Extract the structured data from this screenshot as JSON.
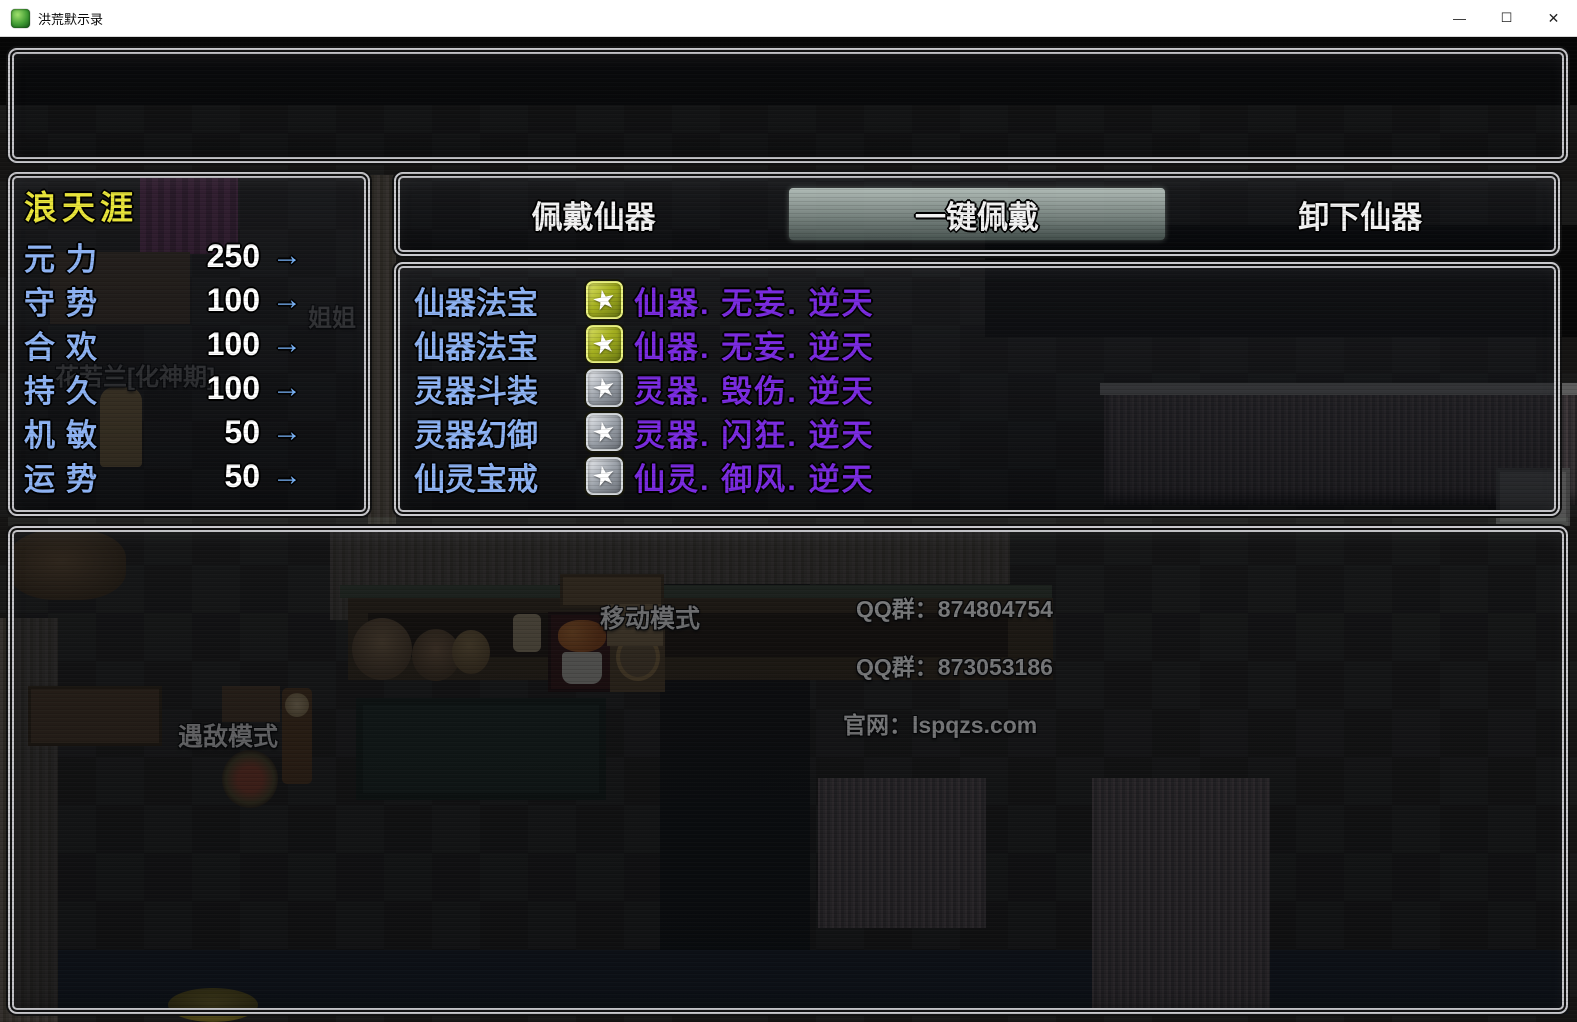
{
  "window": {
    "title": "洪荒默示录",
    "controls": {
      "minimize": "—",
      "maximize": "☐",
      "close": "✕"
    }
  },
  "stats_panel": {
    "character_name": "浪天涯",
    "stats": [
      {
        "label": "元力",
        "value": "250",
        "arrow": "→"
      },
      {
        "label": "守势",
        "value": "100",
        "arrow": "→"
      },
      {
        "label": "合欢",
        "value": "100",
        "arrow": "→"
      },
      {
        "label": "持久",
        "value": "100",
        "arrow": "→"
      },
      {
        "label": "机敏",
        "value": "50",
        "arrow": "→"
      },
      {
        "label": "运势",
        "value": "50",
        "arrow": "→"
      }
    ]
  },
  "tab_bar": {
    "tabs": [
      {
        "label": "佩戴仙器",
        "selected": false
      },
      {
        "label": "一键佩戴",
        "selected": true
      },
      {
        "label": "卸下仙器",
        "selected": false
      }
    ]
  },
  "equipment_panel": {
    "items": [
      {
        "slot": "仙器法宝",
        "star": "gold",
        "star_glyph": "★",
        "name": "仙器. 无妄. 逆天"
      },
      {
        "slot": "仙器法宝",
        "star": "gold",
        "star_glyph": "★",
        "name": "仙器. 无妄. 逆天"
      },
      {
        "slot": "灵器斗装",
        "star": "silver",
        "star_glyph": "★",
        "name": "灵器. 毁伤. 逆天"
      },
      {
        "slot": "灵器幻御",
        "star": "silver",
        "star_glyph": "★",
        "name": "灵器. 闪狂. 逆天"
      },
      {
        "slot": "仙灵宝戒",
        "star": "silver",
        "star_glyph": "★",
        "name": "仙灵. 御风. 逆天"
      }
    ]
  },
  "map_text": {
    "move_mode": "移动模式",
    "encounter_mode": "遇敌模式",
    "qq_group_1": "QQ群：874804754",
    "qq_group_2": "QQ群：873053186",
    "website": "官网：lspqzs.com",
    "npc_label_1": "花若兰[化神期]",
    "npc_label_2": "姐姐"
  },
  "colors": {
    "name_yellow": "#e8e43a",
    "stat_blue": "#8db2f2",
    "item_purple": "#7a2be0",
    "arrow_blue": "#79b2f6",
    "tab_highlight": "#b5c6bd"
  }
}
